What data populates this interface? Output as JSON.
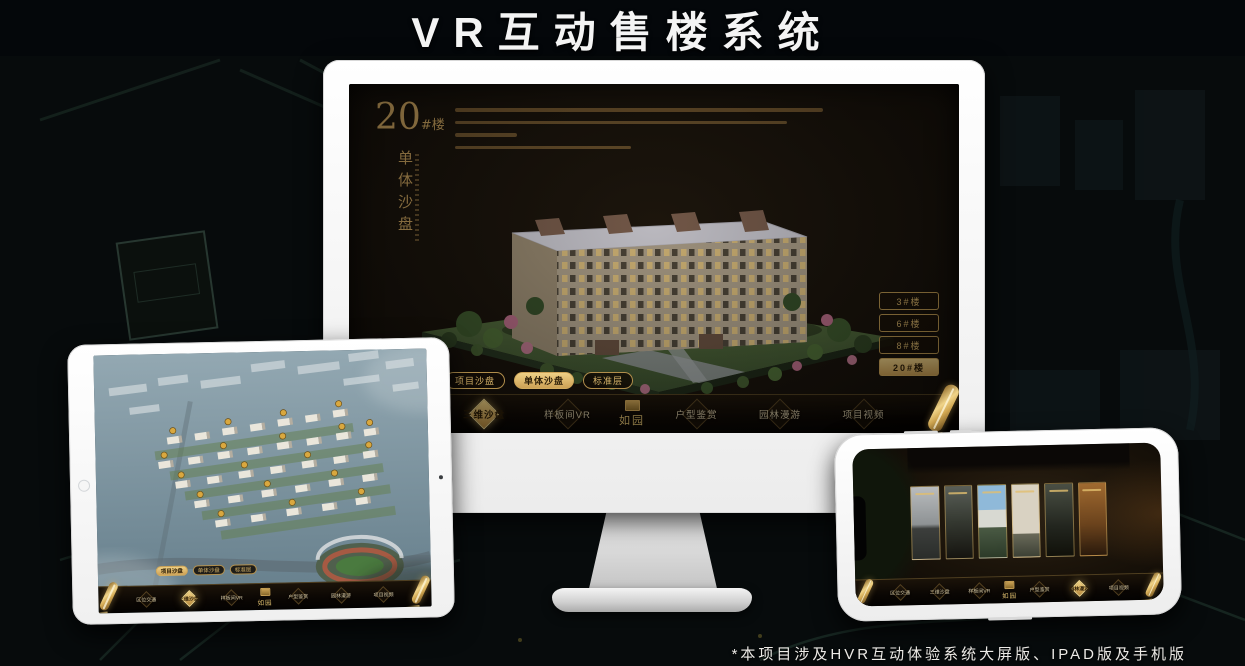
{
  "header": {
    "title": "VR互动售楼系统"
  },
  "footnote": {
    "text": "*本项目涉及HVR互动体验系统大屏版、IPAD版及手机版"
  },
  "colors": {
    "gold": "#c9a25e",
    "gold_bright": "#eed086",
    "screen_bg": "#15100a",
    "active_text": "#2a1c06"
  },
  "monitor": {
    "block": {
      "number": "20",
      "suffix": "#楼",
      "subtitle": "单体沙盘"
    },
    "floor_buttons": [
      {
        "label": "3#楼",
        "active": false
      },
      {
        "label": "6#楼",
        "active": false
      },
      {
        "label": "8#楼",
        "active": false
      },
      {
        "label": "20#楼",
        "active": true
      }
    ],
    "sub_tabs": [
      {
        "label": "项目沙盘",
        "active": false
      },
      {
        "label": "单体沙盘",
        "active": true
      },
      {
        "label": "标准层",
        "active": false
      }
    ],
    "nav_items": [
      {
        "label": "区位交通",
        "active": false
      },
      {
        "label": "三维沙盘",
        "active": true
      },
      {
        "label": "样板间VR",
        "active": false
      },
      {
        "label": "如园",
        "logo": true
      },
      {
        "label": "户型鉴赏",
        "active": false
      },
      {
        "label": "园林漫游",
        "active": false
      },
      {
        "label": "项目视频",
        "active": false
      }
    ],
    "scroll_icon": "scroll-menu-handle"
  },
  "ipad": {
    "sub_tabs": [
      {
        "label": "项目沙盘",
        "active": true
      },
      {
        "label": "单体沙盘",
        "active": false
      },
      {
        "label": "标准层",
        "active": false
      }
    ],
    "nav_items": [
      {
        "label": "区位交通",
        "active": false
      },
      {
        "label": "三维沙盘",
        "active": true
      },
      {
        "label": "样板间VR",
        "active": false
      },
      {
        "label": "如园",
        "logo": true
      },
      {
        "label": "户型鉴赏",
        "active": false
      },
      {
        "label": "园林漫游",
        "active": false
      },
      {
        "label": "项目视频",
        "active": false
      }
    ]
  },
  "phone": {
    "nav_items": [
      {
        "label": "区位交通",
        "active": false
      },
      {
        "label": "三维沙盘",
        "active": false
      },
      {
        "label": "样板间VR",
        "active": false
      },
      {
        "label": "如园",
        "logo": true
      },
      {
        "label": "户型鉴赏",
        "active": false
      },
      {
        "label": "园林漫游",
        "active": true
      },
      {
        "label": "项目视频",
        "active": false
      }
    ]
  }
}
